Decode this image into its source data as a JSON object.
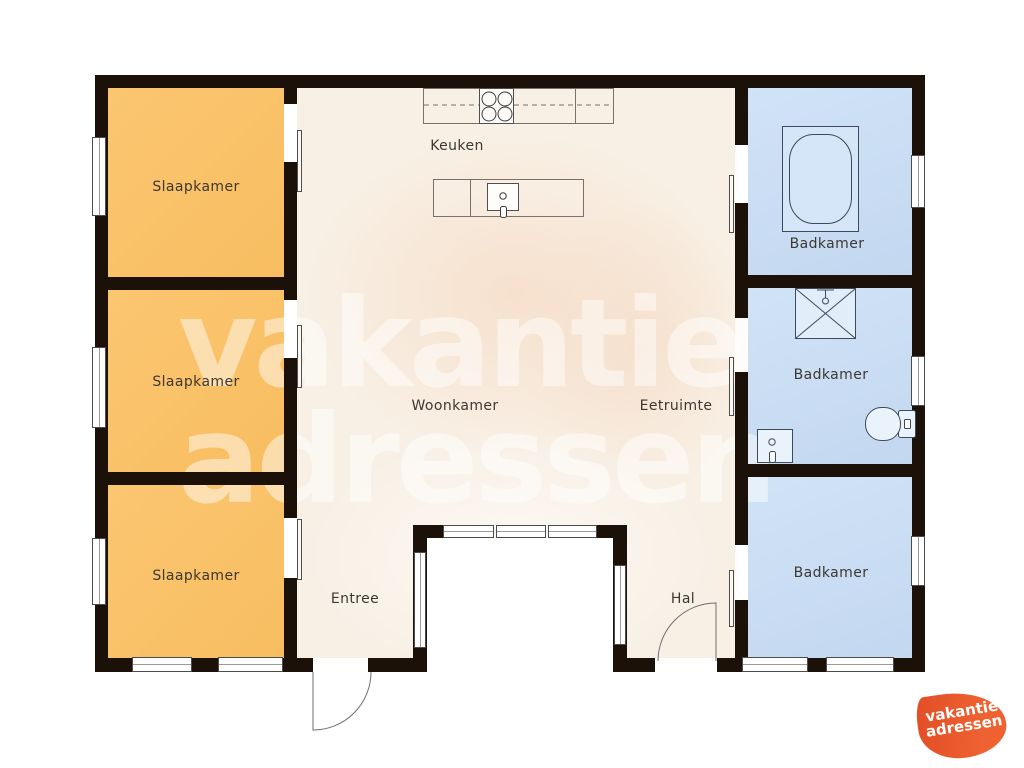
{
  "watermark": {
    "line1": "vakantie",
    "line2": "adressen"
  },
  "logo": {
    "line1": "vakantie",
    "line2": "adressen"
  },
  "rooms": {
    "bedroom1": {
      "label": "Slaapkamer"
    },
    "bedroom2": {
      "label": "Slaapkamer"
    },
    "bedroom3": {
      "label": "Slaapkamer"
    },
    "kitchen": {
      "label": "Keuken"
    },
    "living": {
      "label": "Woonkamer"
    },
    "dining": {
      "label": "Eetruimte"
    },
    "bathroom1": {
      "label": "Badkamer"
    },
    "bathroom2": {
      "label": "Badkamer"
    },
    "bathroom3": {
      "label": "Badkamer"
    },
    "entry": {
      "label": "Entree"
    },
    "hall": {
      "label": "Hal"
    }
  },
  "fixtures": [
    "stove",
    "kitchen-counter",
    "kitchen-island-sink",
    "bathtub",
    "shower",
    "toilet",
    "washbasin",
    "entry-door-swing",
    "hall-door-swing"
  ],
  "colors": {
    "bedroom_fill": "#F8BE63",
    "bathroom_fill": "#C9DEF4",
    "floor_fill": "#F8F0E5",
    "wall": "#1B1108",
    "outside": "#FFFFFF",
    "logo_orange": "#E8572C",
    "watermark_white": "rgba(255,255,255,0.48)",
    "label_text": "#3E3831"
  }
}
